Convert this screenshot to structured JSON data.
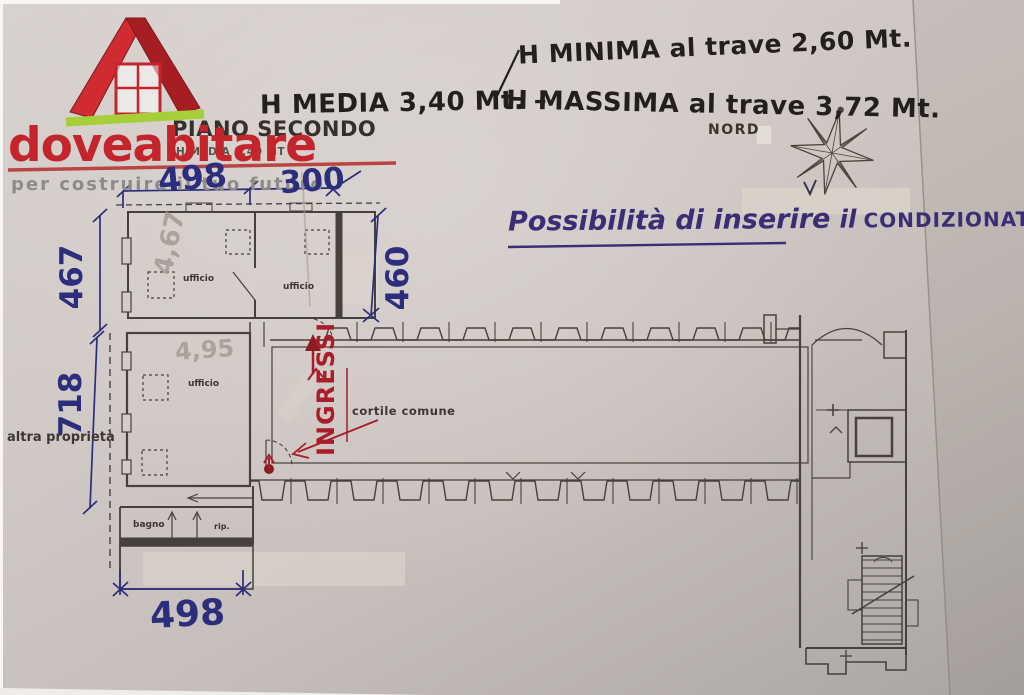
{
  "logo": {
    "brand": "doveabitare",
    "tagline": "per costruire il tuo futuro"
  },
  "header": {
    "plan_title": "PIANO SECONDO",
    "plan_subtitle": "H MEDIA 3,40 MT",
    "north_label": "NORD"
  },
  "notes": {
    "h_minima": "H MINIMA al trave 2,60 Mt.",
    "h_media": "H MEDIA 3,40 Mt. –",
    "h_massima": "H MASSIMA al trave 3,72 Mt.",
    "air_1": "Possibilità di inserire",
    "air_2": "il",
    "air_3": "CONDIZIONATORE.",
    "entrances": "INGRESSI"
  },
  "dimensions": {
    "top_left": "498",
    "top_right": "300",
    "left_upper": "467",
    "right_upper": "460",
    "left_lower": "718",
    "bottom": "498",
    "pencil_upper": "4,67",
    "pencil_lower": "4,95"
  },
  "rooms": {
    "office_top_left": "ufficio",
    "office_top_right": "ufficio",
    "office_mid": "ufficio",
    "courtyard": "cortile comune",
    "bathroom": "bagno",
    "storage": "rip.",
    "boundary_label": "altra proprietà"
  },
  "colors": {
    "brand_red": "#c4242b",
    "logo_green": "#a6ce39",
    "ink_blue": "#2c2d7d",
    "ink_red": "#a81d27",
    "ink_purple": "#3a2d75",
    "marker_black": "#221f1c",
    "pencil_gray": "#a49c92",
    "plan_line": "#46413c",
    "paper": "#cdc6c1"
  }
}
